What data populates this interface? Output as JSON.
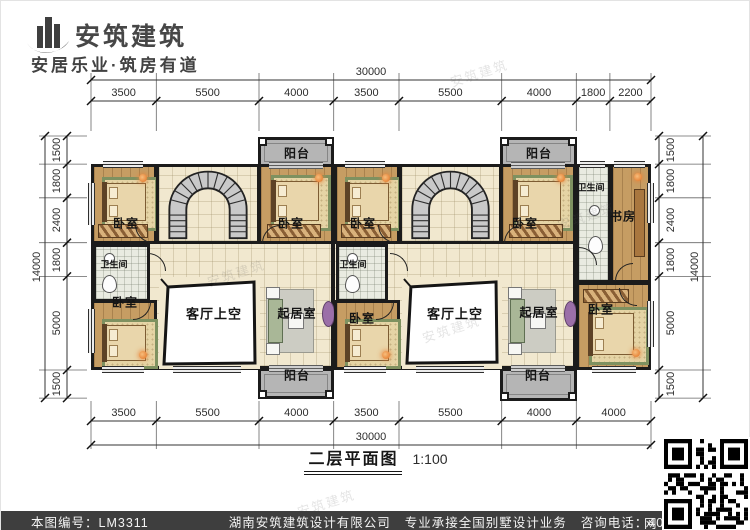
{
  "header": {
    "brand": "安筑建筑",
    "slogan": "安居乐业·筑房有道"
  },
  "title": {
    "text": "二层平面图",
    "scale": "1:100"
  },
  "dims": {
    "top": {
      "total": "30000",
      "segments": [
        "3500",
        "5500",
        "4000",
        "3500",
        "5500",
        "4000",
        "1800",
        "2200"
      ]
    },
    "bottom": {
      "total": "30000",
      "segments": [
        "3500",
        "5500",
        "4000",
        "3500",
        "5500",
        "4000",
        "4000"
      ]
    },
    "left": {
      "total": "14000",
      "segments": [
        "1500",
        "1800",
        "2400",
        "1800",
        "5000",
        "1500"
      ]
    },
    "right": {
      "total": "14000",
      "segments": [
        "1500",
        "1800",
        "2400",
        "1800",
        "5000",
        "1500"
      ]
    }
  },
  "rooms": {
    "a1": "卧室",
    "a2": "卧室",
    "a3": "卧室",
    "bath_a": "卫生间",
    "void_a": "客厅上空",
    "sit_a": "起居室",
    "balc_top_a": "阳台",
    "balc_bot_a": "阳台",
    "b1": "卧室",
    "b2": "卧室",
    "b3": "卧室",
    "b4": "卧室",
    "bath_b": "卫生间",
    "bath_b_top": "卫生间",
    "study": "书房",
    "void_b": "客厅上空",
    "sit_b": "起居室",
    "balc_top_b": "阳台",
    "balc_bot_b": "阳台"
  },
  "watermark": "安筑建筑",
  "footer": {
    "code": "本图编号：LM3311",
    "company": "湖南安筑建筑设计有限公司",
    "service": "专业承接全国别墅设计业务",
    "phone": "咨询电话：400-8070-511",
    "net": "网"
  },
  "colors": {
    "wall": "#1b1b1b",
    "wood": "#c69d63",
    "tile": "#f1e8cf",
    "footer_bg": "#3e3e3e",
    "accent": "#e8833a"
  }
}
